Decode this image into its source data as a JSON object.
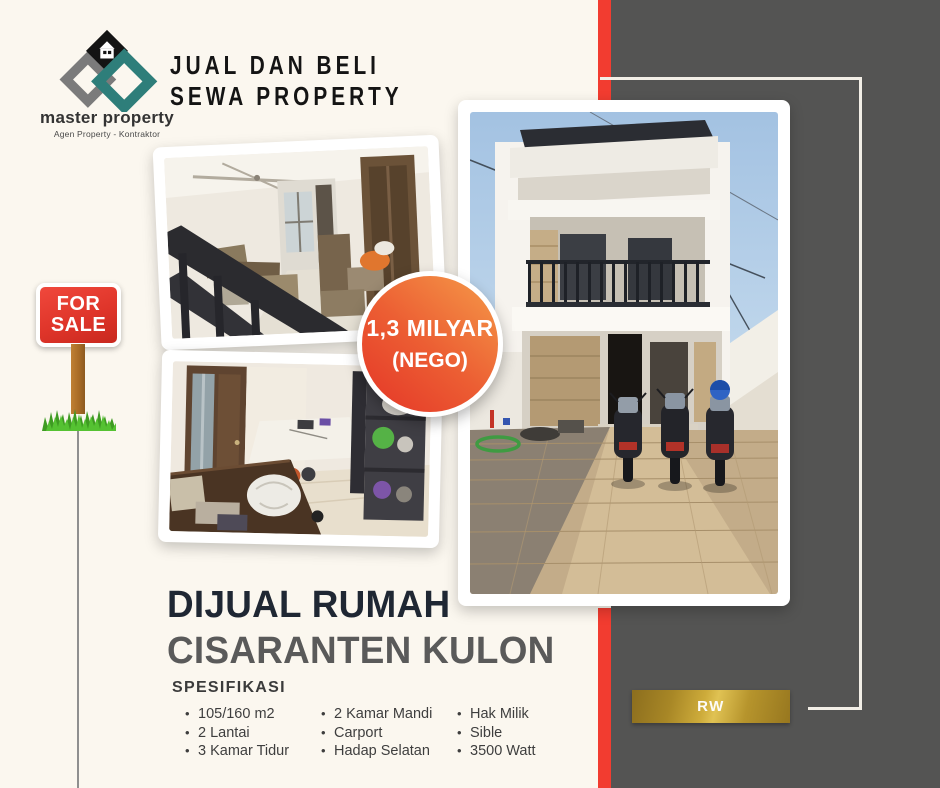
{
  "brand": {
    "logo_name": "master property",
    "logo_tagline": "Agen Property - Kontraktor",
    "heading_line1": "JUAL DAN BELI",
    "heading_line2": "SEWA PROPERTY"
  },
  "for_sale_sign": {
    "line1": "FOR",
    "line2": "SALE"
  },
  "price_badge": {
    "amount": "1,3 MILYAR",
    "note": "(NEGO)"
  },
  "listing": {
    "title": "DIJUAL RUMAH",
    "location": "CISARANTEN KULON",
    "spec_heading": "SPESIFIKASI",
    "spec_columns": [
      {
        "items": [
          "105/160 m2",
          "2 Lantai",
          "3 Kamar Tidur"
        ]
      },
      {
        "items": [
          "2 Kamar Mandi",
          "Carport",
          "Hadap Selatan"
        ]
      },
      {
        "items": [
          "Hak Milik",
          "Sible",
          "3500 Watt"
        ]
      }
    ]
  },
  "side_panel": {
    "badge_label": "RW"
  },
  "icons": {
    "bullet_glyph": "•"
  },
  "colors": {
    "background": "#fbf7ef",
    "panel_gray": "#545453",
    "accent_red": "#f23c30",
    "badge_gradient_from": "#e43527",
    "badge_gradient_to": "#f59b49",
    "gold": "#cdab3a",
    "title_navy": "#1f2733",
    "title_gray": "#5a5a5a",
    "logo_teal": "#2e7e7a",
    "sign_red": "#df352a"
  }
}
